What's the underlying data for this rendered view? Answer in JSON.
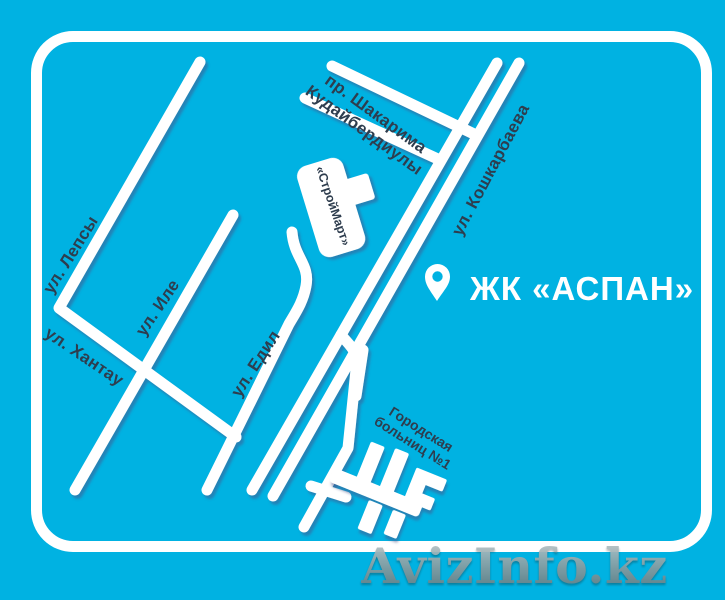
{
  "map": {
    "colors": {
      "background": "#00b2e2",
      "road": "#ffffff",
      "road_shadow": "#44518a",
      "label_text": "#2e3d4e",
      "frame": "#ffffff",
      "complex_title_text": "#ffffff"
    },
    "streets": [
      {
        "id": "lepsy",
        "label": "ул. Лепсы"
      },
      {
        "id": "ile",
        "label": "ул. Иле"
      },
      {
        "id": "khantau",
        "label": "ул. Хантау"
      },
      {
        "id": "edil",
        "label": "ул. Едил"
      },
      {
        "id": "shakarima",
        "label": "пр. Шакарима Кудайбердиулы",
        "line1": "пр. Шакарима",
        "line2": "Кудайбердиулы"
      },
      {
        "id": "koshkarbaeva",
        "label": "ул. Кошкарбаева"
      }
    ],
    "places": [
      {
        "id": "stroymart",
        "label": "«СтройМарт»"
      },
      {
        "id": "hospital",
        "label": "Городская больниц №1",
        "line1": "Городская",
        "line2": "больниц №1"
      },
      {
        "id": "aspan",
        "label": "ЖК «АСПАН»"
      }
    ]
  },
  "watermark": {
    "text": "AvizInfo.kz"
  }
}
